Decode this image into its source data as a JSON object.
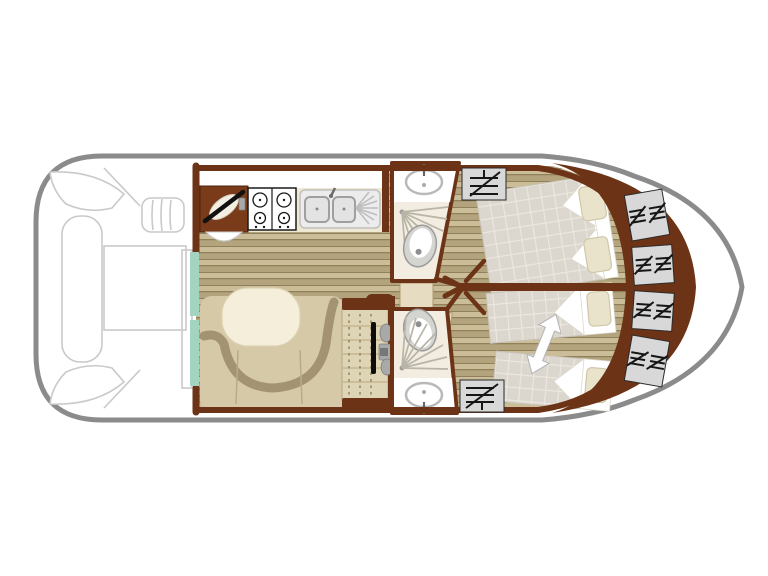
{
  "palette": {
    "background": "#ffffff",
    "hull_outline": "#8b8b8b",
    "deck_furniture_outline": "#c9c9c9",
    "wall": "#6d3316",
    "cabinet_wood": "#7a3b1a",
    "floor_plank_light": "#cabd98",
    "floor_plank_dark": "#b3a47d",
    "floor_plank_seam": "#82724d",
    "sliding_door_teal": "#a3d4bf",
    "counter": "#efe8d2",
    "sofa": "#d6c9a8",
    "sofa_trim": "#a39372",
    "table": "#f5eedb",
    "bathroom_floor": "#f2ede0",
    "fixture_gray": "#b9b9b9",
    "bed_quilt": "#dcd7ce",
    "bed_grid": "#ece8e0",
    "pillow": "#e9e3cc",
    "shelf_panel": "#d8d8d8",
    "shelf_icon": "#161616",
    "steel": "#a9a9a9"
  },
  "floorplan": {
    "kind": "boat-deck-plan",
    "orientation": "bow-right",
    "areas": [
      {
        "id": "aft-deck",
        "fixtures": [
          "corner-bench-port",
          "corner-bench-starboard",
          "sun-lounger",
          "deck-table",
          "boarding-steps",
          "door-frame"
        ]
      },
      {
        "id": "sliding-patio-door",
        "fixtures": [
          "teal-door-leaf-upper",
          "teal-door-leaf-lower"
        ]
      },
      {
        "id": "galley",
        "fixtures": [
          "helm-cabinet-with-wheel",
          "helm-seat",
          "four-burner-hob",
          "double-sink-with-drainer",
          "counter"
        ]
      },
      {
        "id": "saloon",
        "fixtures": [
          "u-shaped-sofa",
          "oval-table",
          "wood-plank-floor"
        ]
      },
      {
        "id": "sideboard",
        "fixtures": [
          "shelf-columns",
          "grab-rail",
          "hardware-cluster"
        ]
      },
      {
        "id": "shower-room-port",
        "fixtures": [
          "washbasin",
          "shower",
          "toilet",
          "door-leaf"
        ]
      },
      {
        "id": "shower-room-starboard",
        "fixtures": [
          "toilet",
          "shower",
          "washbasin",
          "door-leaf"
        ]
      },
      {
        "id": "cabin-port",
        "fixtures": [
          "double-bed",
          "pillow",
          "pillow",
          "shelf-unit"
        ]
      },
      {
        "id": "cabin-starboard",
        "fixtures": [
          "single-bed",
          "single-bed",
          "convertible-double-arrow",
          "pillow",
          "pillow",
          "shelf-unit"
        ]
      },
      {
        "id": "bow-stowage",
        "fixtures": [
          "shelf-panel",
          "shelf-panel",
          "shelf-panel",
          "shelf-panel"
        ]
      }
    ]
  }
}
